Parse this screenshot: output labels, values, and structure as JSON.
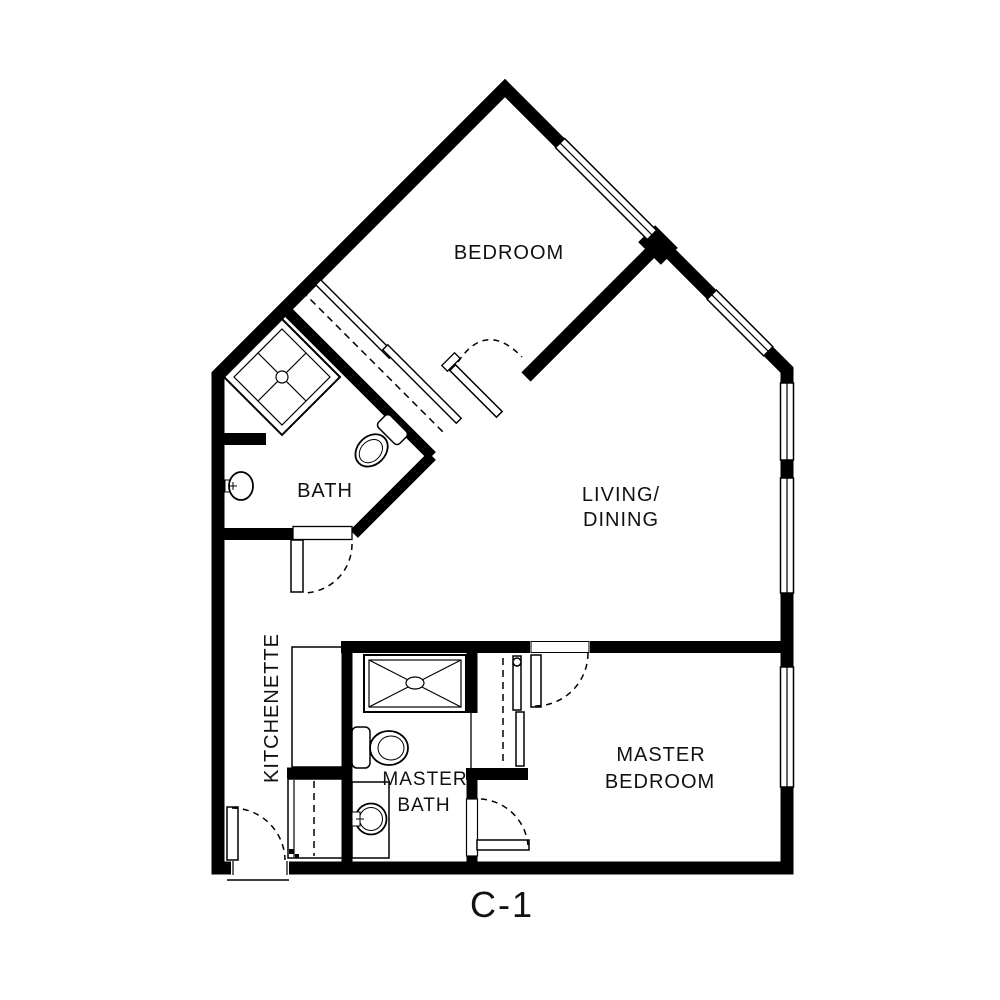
{
  "plan": {
    "code": "C-1"
  },
  "colors": {
    "wall": "#000000",
    "background": "#ffffff"
  },
  "rooms": {
    "bedroom": {
      "label": "BEDROOM"
    },
    "living_dining": {
      "line1": "LIVING/",
      "line2": "DINING"
    },
    "bath": {
      "label": "BATH"
    },
    "kitchenette": {
      "label": "KITCHENETTE"
    },
    "master_bath": {
      "line1": "MASTER",
      "line2": "BATH"
    },
    "master_bedroom": {
      "line1": "MASTER",
      "line2": "BEDROOM"
    }
  }
}
